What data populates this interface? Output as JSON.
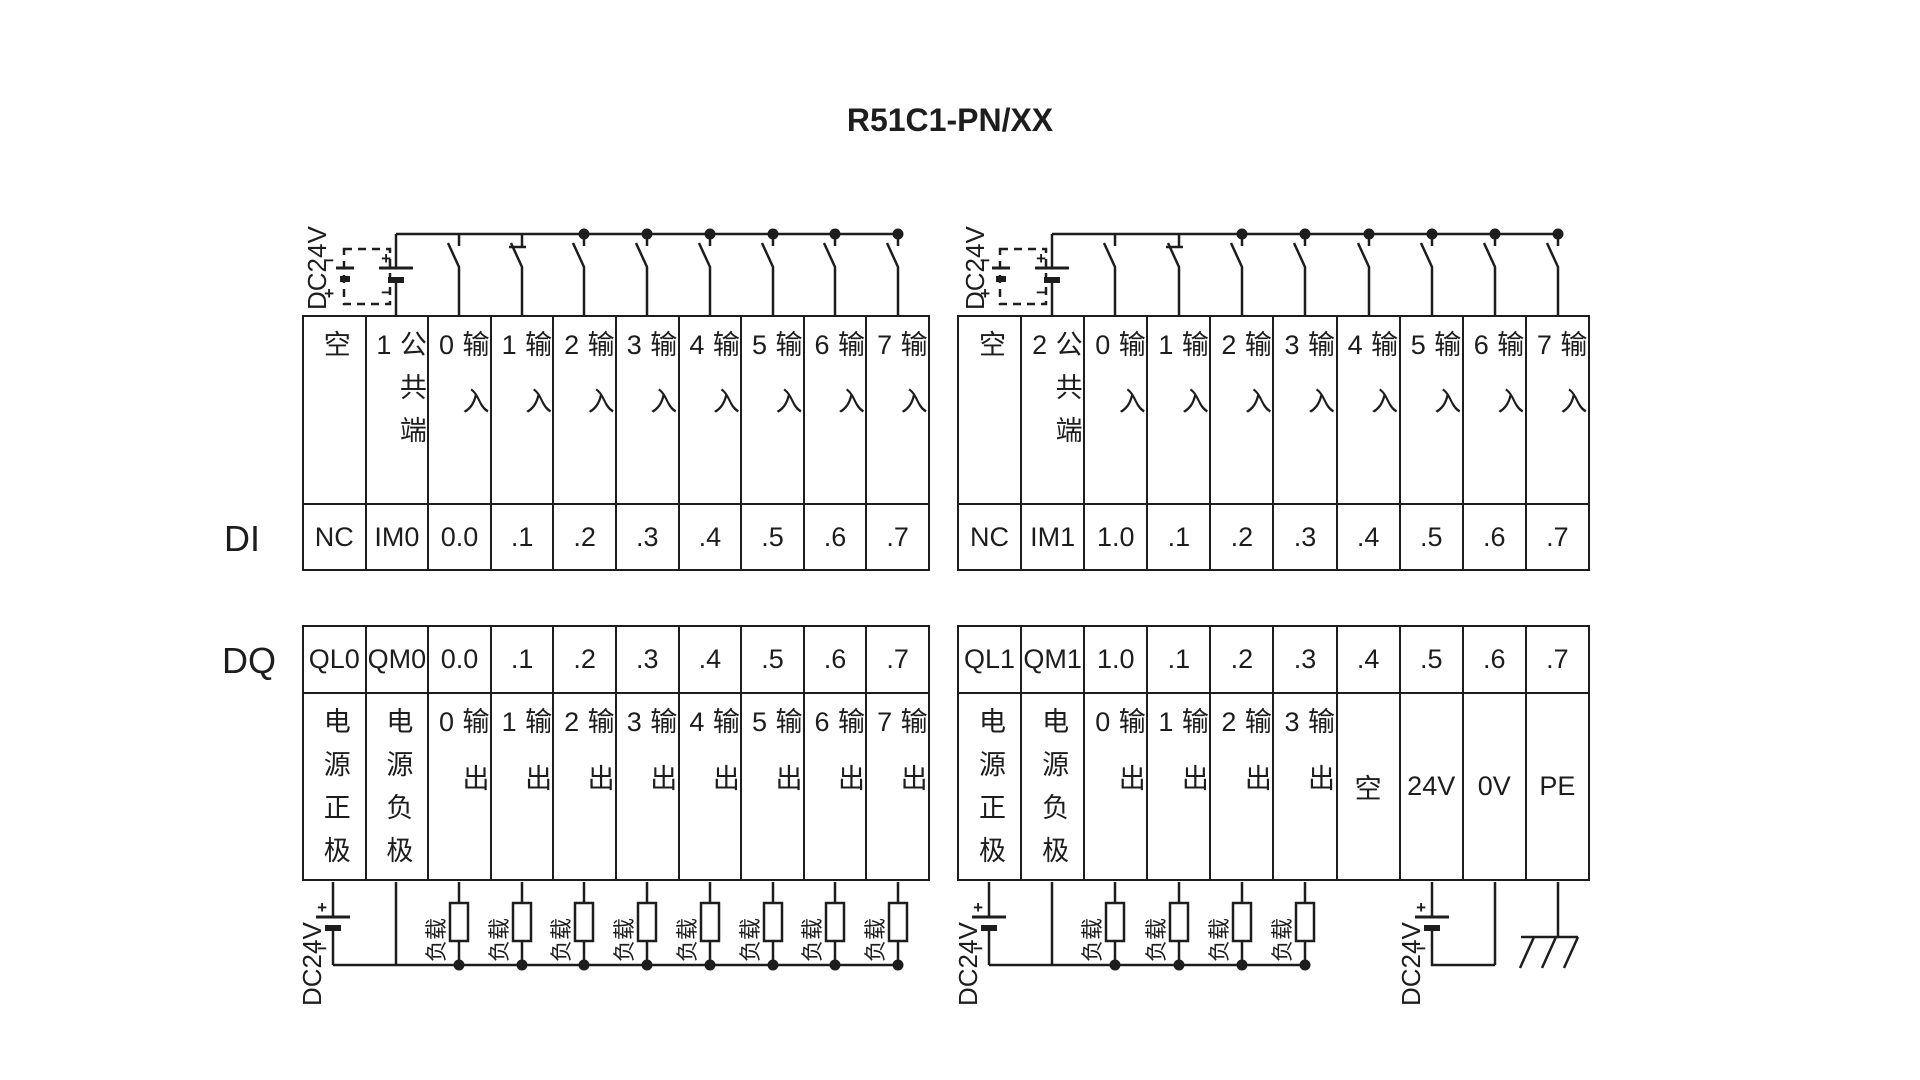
{
  "title": "R51C1-PN/XX",
  "sections": {
    "di_label": "DI",
    "dq_label": "DQ"
  },
  "circuit": {
    "dc24v_label": "DC24V",
    "load_label": "负载",
    "plus": "+",
    "minus": "−"
  },
  "di_left": {
    "headers": [
      "空",
      "公共端1",
      "输入0",
      "输入1",
      "输入2",
      "输入3",
      "输入4",
      "输入5",
      "输入6",
      "输入7"
    ],
    "terminals": [
      "NC",
      "IM0",
      "0.0",
      ".1",
      ".2",
      ".3",
      ".4",
      ".5",
      ".6",
      ".7"
    ]
  },
  "di_right": {
    "headers": [
      "空",
      "公共端2",
      "输入0",
      "输入1",
      "输入2",
      "输入3",
      "输入4",
      "输入5",
      "输入6",
      "输入7"
    ],
    "terminals": [
      "NC",
      "IM1",
      "1.0",
      ".1",
      ".2",
      ".3",
      ".4",
      ".5",
      ".6",
      ".7"
    ]
  },
  "dq_left": {
    "terminals": [
      "QL0",
      "QM0",
      "0.0",
      ".1",
      ".2",
      ".3",
      ".4",
      ".5",
      ".6",
      ".7"
    ],
    "functions": [
      "电源正极",
      "电源负极",
      "输出0",
      "输出1",
      "输出2",
      "输出3",
      "输出4",
      "输出5",
      "输出6",
      "输出7"
    ]
  },
  "dq_right": {
    "terminals": [
      "QL1",
      "QM1",
      "1.0",
      ".1",
      ".2",
      ".3",
      ".4",
      ".5",
      ".6",
      ".7"
    ],
    "functions": [
      "电源正极",
      "电源负极",
      "输出0",
      "输出1",
      "输出2",
      "输出3",
      "空",
      "24V",
      "0V",
      "PE"
    ]
  }
}
